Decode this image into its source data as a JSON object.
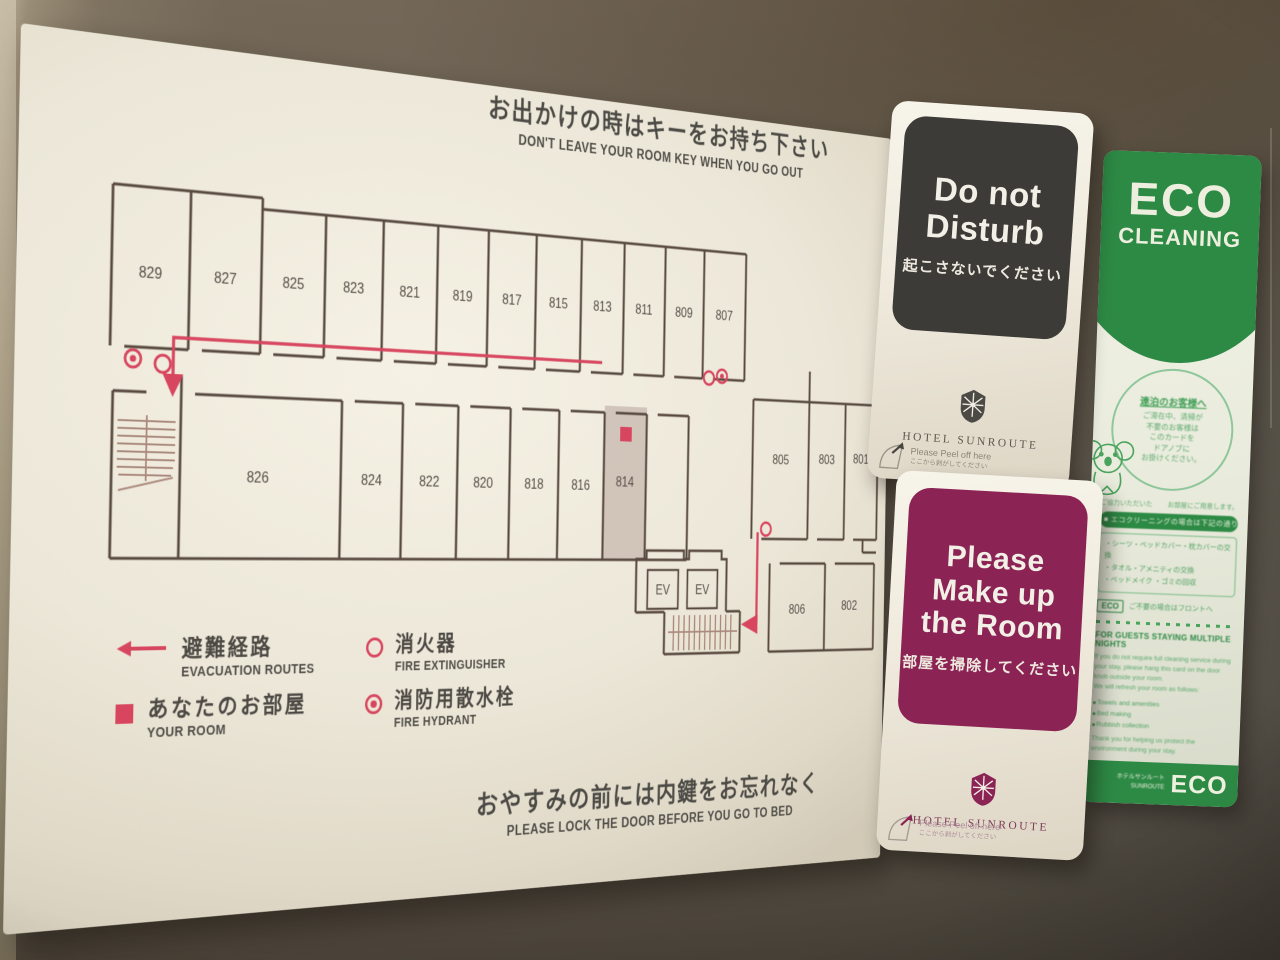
{
  "colors": {
    "red": "#d8455f",
    "dark_panel": "#3c3b37",
    "magenta": "#8c2355",
    "green": "#2d8a45",
    "board_cream": "#ece7d8",
    "plan_line": "#594a40"
  },
  "board": {
    "top_title_jp": "お出かけの時はキーをお持ち下さい",
    "top_title_en": "DON'T LEAVE YOUR ROOM KEY WHEN YOU GO OUT",
    "bottom_title_jp": "おやすみの前には内鍵をお忘れなく",
    "bottom_title_en": "PLEASE LOCK THE DOOR BEFORE YOU GO TO BED",
    "plan": {
      "top_row": [
        "829",
        "827",
        "825",
        "823",
        "821",
        "819",
        "817",
        "815",
        "813",
        "811",
        "809",
        "807"
      ],
      "bottom_row": [
        "826",
        "824",
        "822",
        "820",
        "818",
        "816",
        "814"
      ],
      "right_upper": [
        "805",
        "803",
        "801"
      ],
      "right_lower": [
        "806",
        "802"
      ],
      "elevator": "EV",
      "your_room_number": "814"
    },
    "legend": {
      "evac_jp": "避難経路",
      "evac_en": "EVACUATION ROUTES",
      "room_jp": "あなたのお部屋",
      "room_en": "YOUR ROOM",
      "ext_jp": "消火器",
      "ext_en": "FIRE EXTINGUISHER",
      "hyd_jp": "消防用散水栓",
      "hyd_en": "FIRE HYDRANT"
    }
  },
  "dnd": {
    "line1": "Do not",
    "line2": "Disturb",
    "jp": "起こさないでください",
    "hotel": "HOTEL SUNROUTE",
    "peel_en": "Please Peel off here",
    "peel_jp": "ここから剥がしてください"
  },
  "makeup": {
    "line1": "Please",
    "line2": "Make up",
    "line3": "the Room",
    "jp": "部屋を掃除してください",
    "hotel": "HOTEL SUNROUTE",
    "peel_en": "Please Peel off here",
    "peel_jp": "ここから剥がしてください"
  },
  "eco": {
    "title1": "ECO",
    "title2": "CLEANING",
    "circle_heading": "連泊のお客様へ",
    "circle_l1": "ご滞在中、清掃が",
    "circle_l2": "不要のお客様は",
    "circle_l3": "このカードを",
    "circle_l4": "ドアノブに",
    "circle_l5": "お掛けください。",
    "row_left": "ご協力いただいた",
    "row_right": "お部屋にご用意します。",
    "pill": "■ エコクリーニングの場合は下記の通り",
    "box_l1": "・シーツ・ベッドカバー・枕カバーの交換",
    "box_l2": "・タオル・アメニティの交換",
    "box_l3": "・ベッドメイク ・ゴミの回収",
    "note": "ご不要の場合はフロントへ",
    "badge": "ECO",
    "en_heading": "FOR GUESTS STAYING MULTIPLE NIGHTS",
    "en_l1": "If you do not require full cleaning service during",
    "en_l2": "your stay, please hang this card on the door",
    "en_l3": "knob outside your room.",
    "en_l4": "We will refresh your room as follows:",
    "bullet1": "Towels and amenities",
    "bullet2": "Bed making",
    "bullet3": "Rubbish collection",
    "en_note1": "Thank you for helping us protect the",
    "en_note2": "environment during your stay.",
    "foot_small1": "ホテルサンルート",
    "foot_small2": "SUNROUTE",
    "foot_big": "ECO"
  }
}
